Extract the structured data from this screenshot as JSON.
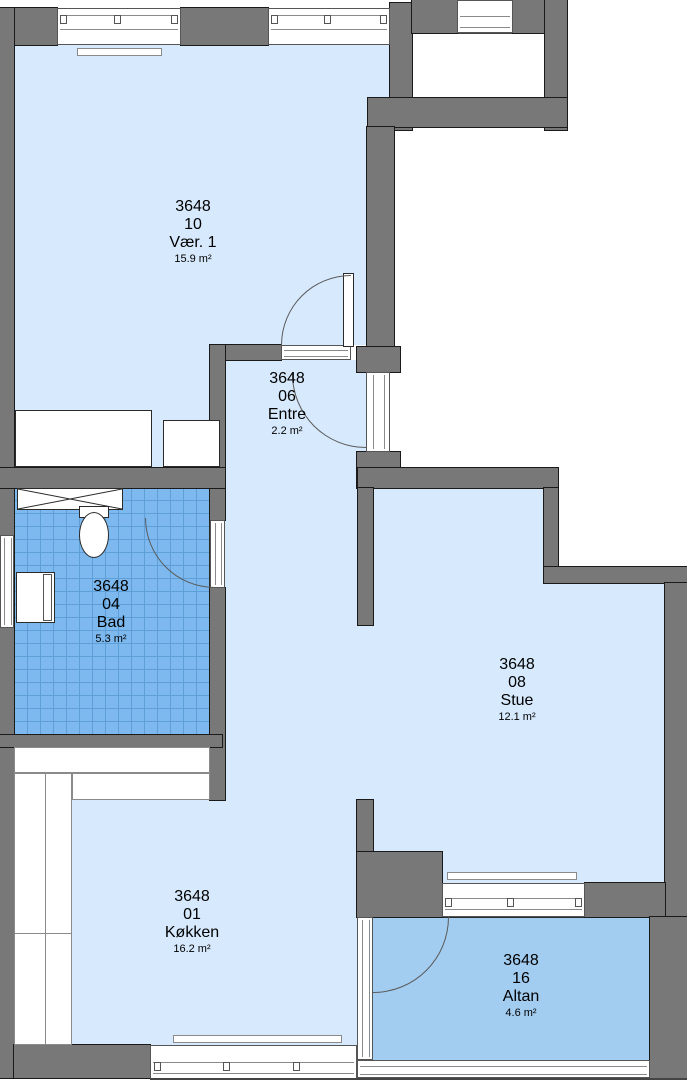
{
  "plan": {
    "unit_id": "3648",
    "rooms": {
      "vaer1": {
        "unit": "3648",
        "number": "10",
        "name": "Vær. 1",
        "area": "15.9 m²"
      },
      "entre": {
        "unit": "3648",
        "number": "06",
        "name": "Entre",
        "area": "2.2 m²"
      },
      "bad": {
        "unit": "3648",
        "number": "04",
        "name": "Bad",
        "area": "5.3 m²"
      },
      "stue": {
        "unit": "3648",
        "number": "08",
        "name": "Stue",
        "area": "12.1 m²"
      },
      "kokken": {
        "unit": "3648",
        "number": "01",
        "name": "Køkken",
        "area": "16.2 m²"
      },
      "altan": {
        "unit": "3648",
        "number": "16",
        "name": "Altan",
        "area": "4.6 m²"
      }
    },
    "colors": {
      "room_fill": "#d7e9fc",
      "bad_fill": "#7db9ef",
      "bad_grid": "#5e9fd8",
      "altan_fill": "#a3cdf0",
      "wall": "#787878"
    }
  }
}
